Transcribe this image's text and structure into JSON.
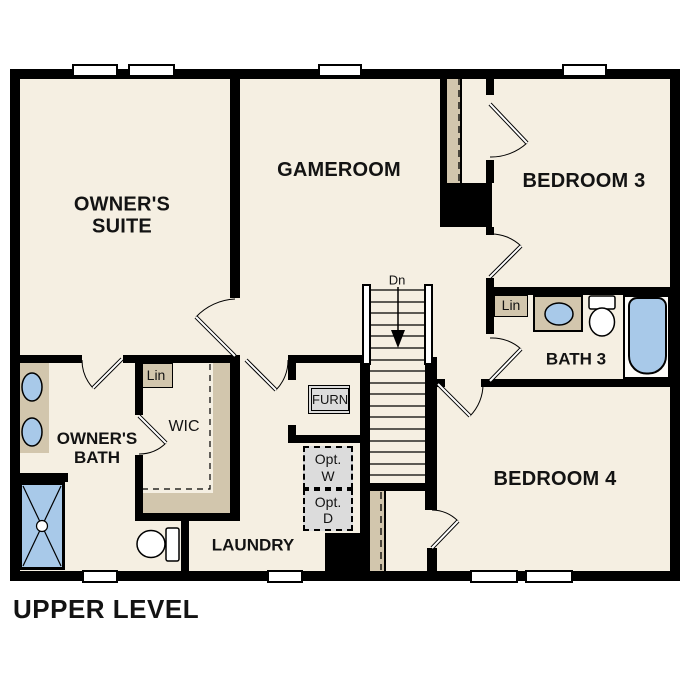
{
  "title": "UPPER LEVEL",
  "colors": {
    "wall": "#000000",
    "floor": "#f5efe2",
    "tan": "#d2c6ad",
    "blue": "#a8c9e9",
    "optgray": "#dcdcdc",
    "bg": "#ffffff"
  },
  "rooms": {
    "owners_suite": {
      "line1": "OWNER'S",
      "line2": "SUITE"
    },
    "gameroom": {
      "label": "GAMEROOM"
    },
    "bedroom3": {
      "label": "BEDROOM 3"
    },
    "bedroom4": {
      "label": "BEDROOM 4"
    },
    "bath3": {
      "label": "BATH 3"
    },
    "owners_bath": {
      "line1": "OWNER'S",
      "line2": "BATH"
    },
    "wic": {
      "label": "WIC"
    },
    "laundry": {
      "label": "LAUNDRY"
    }
  },
  "closets": {
    "linen_wic": "Lin",
    "linen_bath3": "Lin"
  },
  "equipment": {
    "furnace": "FURN",
    "optional_washer": {
      "line1": "Opt.",
      "line2": "W"
    },
    "optional_dryer": {
      "line1": "Opt.",
      "line2": "D"
    }
  },
  "stairs": {
    "direction_label": "Dn"
  },
  "fixtures": {
    "owners_bath": [
      "double-vanity-sinks",
      "shower",
      "toilet"
    ],
    "bath3": [
      "vanity-sink",
      "toilet",
      "bathtub"
    ]
  }
}
